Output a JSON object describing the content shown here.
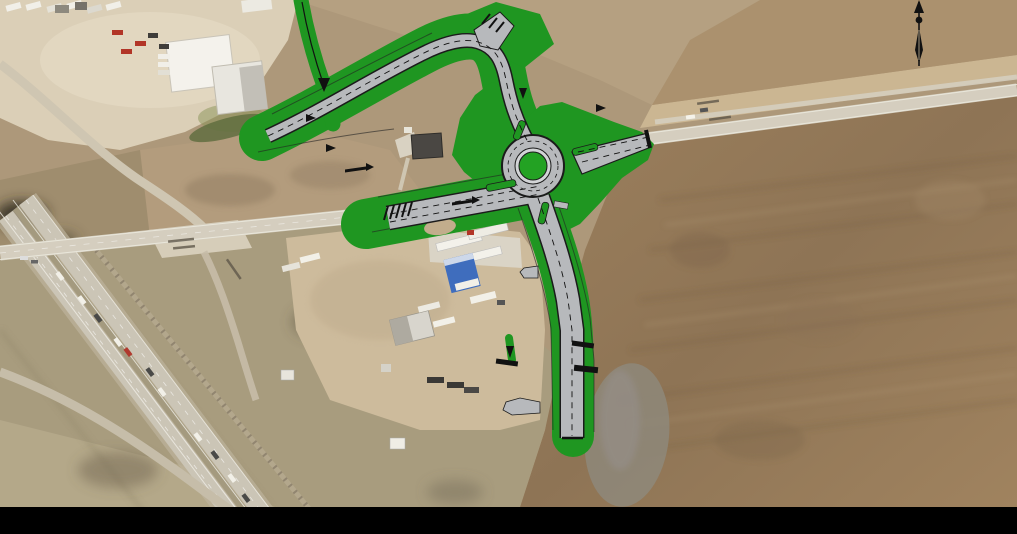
{
  "image": {
    "kind": "aerial-roadway-improvement-plan",
    "subject": "proposed roundabout and realigned highway over aerial photo",
    "width_px": 1017,
    "height_px": 534
  },
  "legend": {
    "landscaping_green": "proposed landscaping / green space",
    "pavement_gray": "proposed roadway pavement",
    "hatch_black": "pavement tie-in / removal hatching",
    "arrows": "traffic and trail direction arrows"
  },
  "colors": {
    "landscape_green": "#1f9621",
    "island_green": "#23a223",
    "pavement_gray": "#b7b9bc",
    "apron_gray": "#d2d4d6",
    "outline_black": "#1b1b1b",
    "marking_black": "#111111",
    "existing_road": "#d5cebf",
    "interstate": "#cbc5b6",
    "field_base": "#ad987a",
    "field_brown": "#977b59",
    "dirt_lot": "#cdbb9c",
    "yard_light": "#dbcfb7",
    "canopy_blue": "#3f6dbd",
    "letterbox": "#000000"
  },
  "north_arrow": {
    "icon": "north-arrow-icon"
  },
  "letterbox": {
    "position": "bottom",
    "height_px": 27
  }
}
